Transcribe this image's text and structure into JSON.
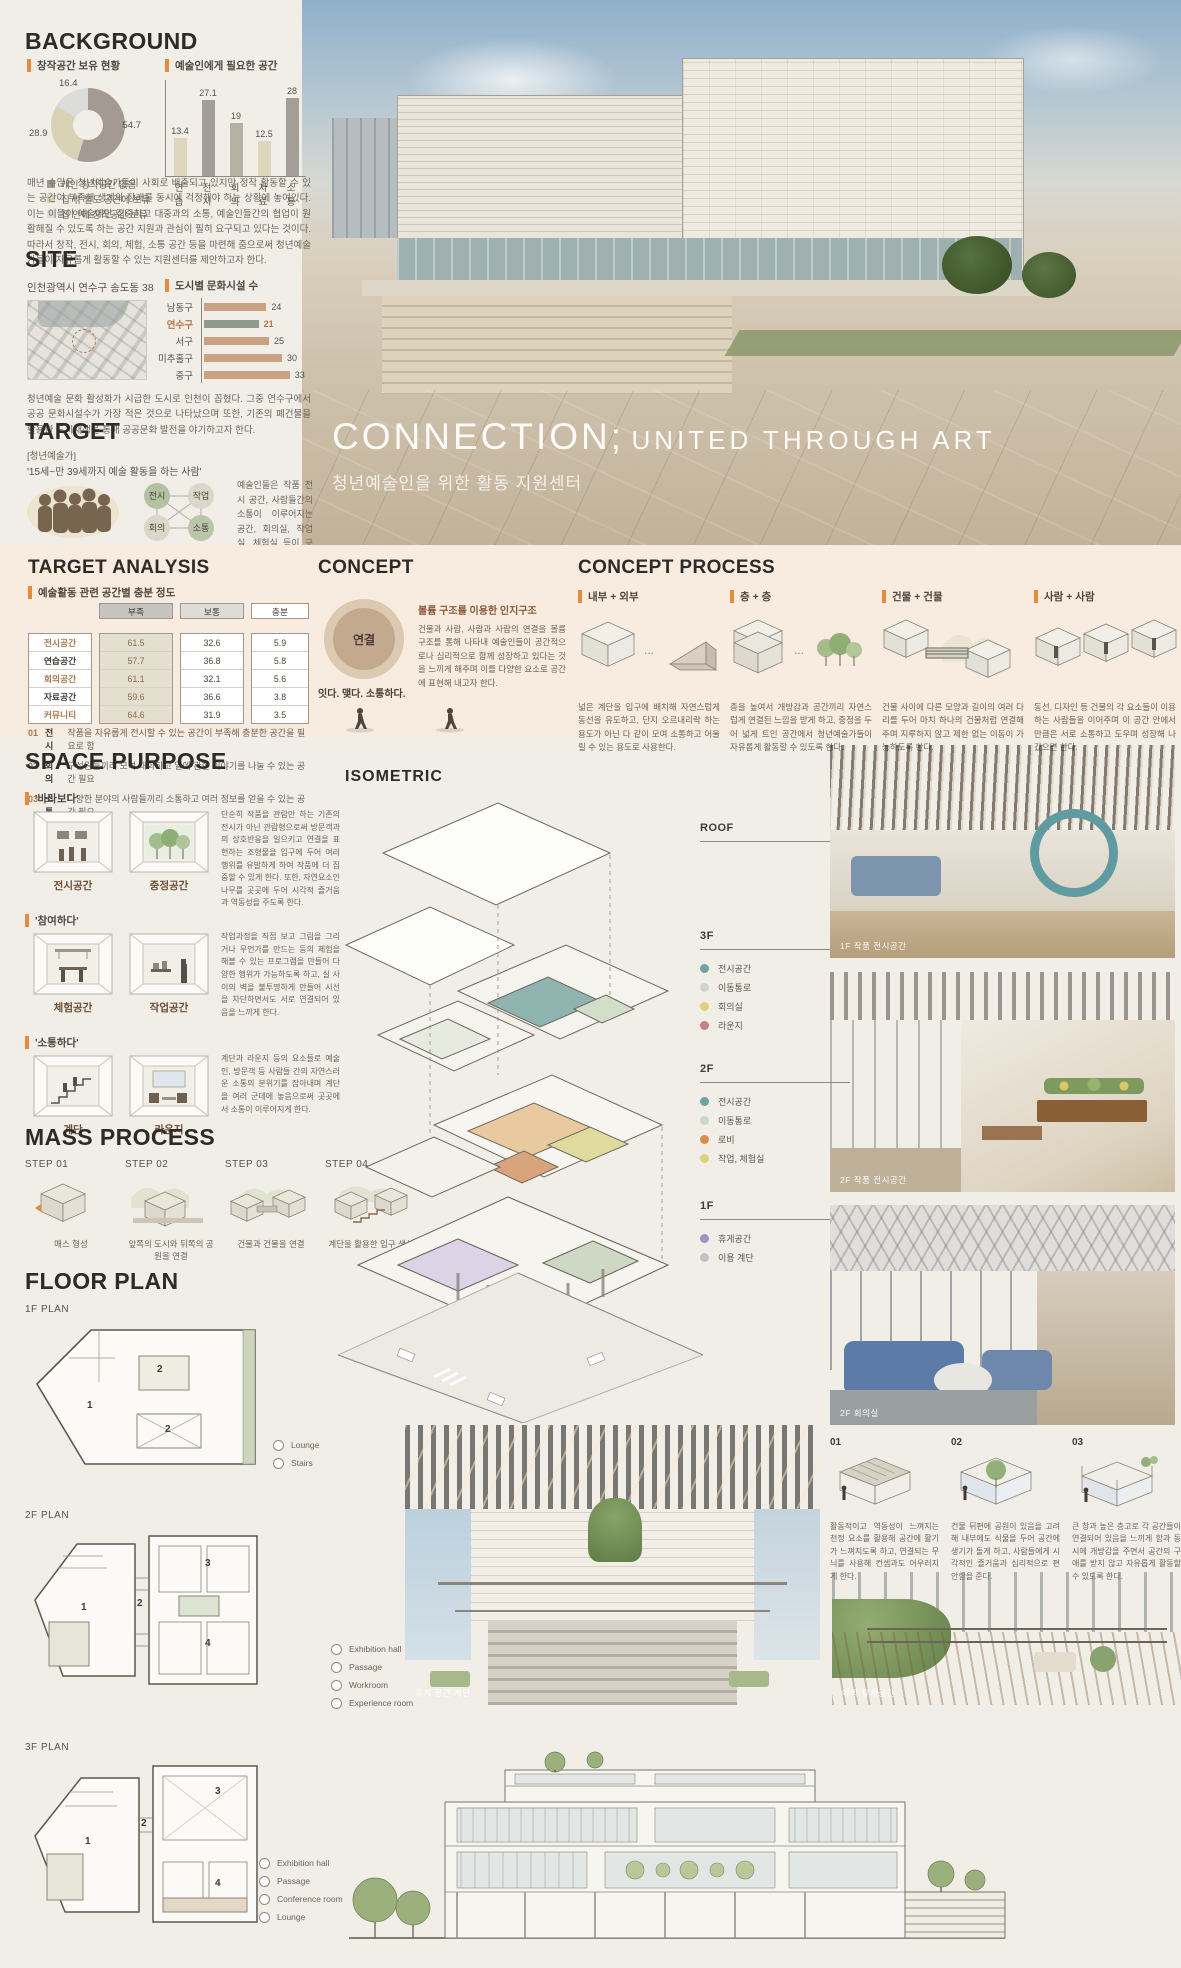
{
  "colors": {
    "accent": "#e58b3f",
    "band": "#f8ebdf",
    "donut": [
      "#a39a93",
      "#d9d2b4",
      "#dcdcda"
    ],
    "bar_beige": "#ddd6bd",
    "bar_gray": "#a49e98",
    "bar_gray2": "#b7b0a5",
    "site_bar": "#c9a183",
    "site_hl": "#8d9a8c",
    "hl_text": "#b0784a"
  },
  "background": {
    "title": "BACKGROUND",
    "donut": {
      "label": "창작공간 보유 현황",
      "values": [
        54.7,
        28.9,
        16.4
      ],
      "value_labels": [
        "54.7",
        "28.9",
        "16.4"
      ],
      "legend": [
        "개인 창작공간 없음",
        "집 밖 별도 공간에 보유",
        "집 안에 창작공간 보유"
      ]
    },
    "needed": {
      "label": "예술인에게 필요한 공간",
      "categories": [
        "연습",
        "전시",
        "회의",
        "자료",
        "소통"
      ],
      "values": [
        13.4,
        27.1,
        19,
        12.5,
        28
      ]
    },
    "paragraph": "매년 수많은 청년예술가들이 사회로 배출되고 있지만 정작 활동할 수 있는 공간이 부족해 생계와 장래를 동시에 걱정해야 하는 상황에 놓여있다. 이는 이들이 예술에만 집중하고 대중과의 소통, 예술인들간의 협업이 원활해질 수 있도록 하는 공간 지원과 관심이 필히 요구되고 있다는 것이다. 따라서 창작, 전시, 회의, 체험, 소통 공간 등을 마련해 줌으로써 청년예술가들이 자유롭게 활동할 수 있는 지원센터를 제안하고자 한다."
  },
  "site": {
    "title": "SITE",
    "address": "인천광역시 연수구 송도동 38",
    "chart": {
      "label": "도시별 문화시설 수",
      "categories": [
        "남동구",
        "연수구",
        "서구",
        "미추홀구",
        "중구"
      ],
      "values": [
        24,
        21,
        25,
        30,
        33
      ],
      "highlight": "연수구"
    },
    "paragraph": "청년예술 문화 활성화가 시급한 도시로 인천이 꼽혔다. 그중 연수구에서 공공 문화시설수가 가장 적은 것으로 나타났으며 또한, 기존의 폐건물을 활용한 도시재생을 통해 공공문화 발전을 야기하고자 한다."
  },
  "target": {
    "title": "TARGET",
    "bracket": "[청년예술가]",
    "quote": "'15세~만 39세까지 예술 활동을 하는 사람'",
    "network": [
      "전시",
      "작업",
      "회의",
      "소통"
    ],
    "paragraph": "예술인들은 작품 전시 공간, 사람들간의 소통이 이루어지는 공간, 회의실, 작업실, 체험실 등이 구비된 자유로운 분위기 속에서 활동하기를 희망한다."
  },
  "hero": {
    "title_main": "CONNECTION;",
    "title_sub": "UNITED THROUGH ART",
    "subtitle": "청년예술인을 위한 활동 지원센터"
  },
  "target_analysis": {
    "title": "TARGET ANALYSIS",
    "label": "예술활동 관련 공간별 충분 정도",
    "headers": [
      "부족",
      "보통",
      "충분"
    ],
    "rows": [
      {
        "name": "전시공간",
        "values": [
          "61.5",
          "32.6",
          "5.9"
        ]
      },
      {
        "name": "연습공간",
        "values": [
          "57.7",
          "36.8",
          "5.8"
        ]
      },
      {
        "name": "회의공간",
        "values": [
          "61.1",
          "32.1",
          "5.6"
        ]
      },
      {
        "name": "자료공간",
        "values": [
          "59.6",
          "36.6",
          "3.8"
        ]
      },
      {
        "name": "커뮤니티",
        "values": [
          "64.6",
          "31.9",
          "3.5"
        ]
      }
    ],
    "notes": [
      {
        "no": "01",
        "label": "전시",
        "text": "작품을 자유롭게 전시할 수 있는 공간이 부족해 충분한 공간을 필요로 함"
      },
      {
        "no": "02",
        "label": "회의",
        "text": "구성원들끼리 모여 대화하고 일에 관한 이야기를 나눌 수 있는 공간 필요"
      },
      {
        "no": "03",
        "label": "소통",
        "text": "다양한 분야의 사람들끼리 소통하고 여러 정보를 얻을 수 있는 공간 필요"
      }
    ]
  },
  "concept": {
    "title": "CONCEPT",
    "circle": "연결",
    "tagline": "잇다. 맺다. 소통하다.",
    "heading": "볼륨 구조를 이용한 인지구조",
    "paragraph": "건물과 사람, 사람과 사람의 연결을 볼륨 구조를 통해 나타내 예술인들이 공간적으로나 심리적으로 함께 성장하고 있다는 것을 느끼게 해주며 이를 다양한 요소로 공간에 표현해 내고자 한다."
  },
  "concept_process": {
    "title": "CONCEPT PROCESS",
    "items": [
      {
        "label": "내부 + 외부",
        "text": "넓은 계단을 입구에 배치해 자연스럽게 동선을 유도하고, 단지 오르내리락 하는 용도가 아닌 다 같이 모여 소통하고 어울릴 수 있는 용도로 사용한다."
      },
      {
        "label": "층 + 층",
        "text": "층을 높여서 개방감과 공간끼리 자연스럽게 연결된 느낌을 받게 하고, 중정을 두어 넓게 트인 공간에서 청년예술가들이 자유롭게 활동할 수 있도록 한다."
      },
      {
        "label": "건물 + 건물",
        "text": "건물 사이에 다른 모양과 길이의 여러 다리를 두어 마치 하나의 건물처럼 연결해주며 지루하지 않고 제한 없는 이동이 가능하도록 한다."
      },
      {
        "label": "사람 + 사람",
        "text": "동선, 디자인 등 건물의 각 요소들이 이용하는 사람들을 이어주며 이 공간 안에서만큼은 서로 소통하고 도우며 성장해 나갔으면 한다."
      }
    ]
  },
  "space_purpose": {
    "title": "SPACE PURPOSE",
    "groups": [
      {
        "quote": "'바라보다'",
        "rooms": [
          "전시공간",
          "중정공간"
        ],
        "text": "단순히 작품을 관람만 하는 기존의 전시가 아닌 관람형으로써 방문객과의 상호반응을 일으키고 연결을 표현하는 조형물을 입구에 두어 여러 행위를 유발하게 하여 작품에 더 집중할 수 있게 한다. 또한, 자연요소인 나무를 곳곳에 두어 시각적 즐거움과 역동성을 주도록 한다."
      },
      {
        "quote": "'참여하다'",
        "rooms": [
          "체험공간",
          "작업공간"
        ],
        "text": "작업과정을 직접 보고 그림을 그리거나 무언가를 만드는 등의 체험을 해볼 수 있는 프로그램을 만들어 다양한 행위가 가능하도록 하고, 실 사이의 벽을 불투명하게 만들어 시선을 차단하면서도 서로 연결되어 있음을 느끼게 한다."
      },
      {
        "quote": "'소통하다'",
        "rooms": [
          "계단",
          "라운지"
        ],
        "text": "계단과 라운지 등의 요소들로 예술인, 방문객 등 사람들 간의 자연스러운 소통의 분위기를 잡아내며 계단을 여러 군데에 놓음으로써 곳곳에서 소통이 이루어지게 한다."
      }
    ]
  },
  "mass_process": {
    "title": "MASS PROCESS",
    "steps": [
      {
        "label": "STEP 01",
        "caption": "매스 형성"
      },
      {
        "label": "STEP 02",
        "caption": "앞쪽의 도시와 뒤쪽의 공원을 연결"
      },
      {
        "label": "STEP 03",
        "caption": "건물과 건물을 연결"
      },
      {
        "label": "STEP 04",
        "caption": "계단을 활용한 입구 생성"
      }
    ]
  },
  "floor_plan": {
    "title": "FLOOR PLAN",
    "plans": [
      {
        "label": "1F PLAN",
        "numbers": [
          "1",
          "2",
          "2"
        ],
        "legend": [
          "Lounge",
          "Stairs"
        ]
      },
      {
        "label": "2F PLAN",
        "numbers": [
          "1",
          "2",
          "3",
          "4"
        ],
        "legend": [
          "Exhibition hall",
          "Passage",
          "Workroom",
          "Experience room"
        ]
      },
      {
        "label": "3F PLAN",
        "numbers": [
          "1",
          "2",
          "3",
          "4"
        ],
        "legend": [
          "Exhibition hall",
          "Passage",
          "Conference room",
          "Lounge"
        ]
      }
    ]
  },
  "isometric": {
    "title": "ISOMETRIC",
    "levels": [
      {
        "name": "ROOF",
        "items": []
      },
      {
        "name": "3F",
        "items": [
          {
            "label": "전시공간",
            "color": "#6fa3a0"
          },
          {
            "label": "이동통로",
            "color": "#ccd6cc"
          },
          {
            "label": "회의실",
            "color": "#ddd37b"
          },
          {
            "label": "라운지",
            "color": "#ca7d89"
          }
        ]
      },
      {
        "name": "2F",
        "items": [
          {
            "label": "전시공간",
            "color": "#6fa3a0"
          },
          {
            "label": "이동통로",
            "color": "#ccd6cc"
          },
          {
            "label": "로비",
            "color": "#dd8a4a"
          },
          {
            "label": "작업, 체험실",
            "color": "#ddd37b"
          }
        ]
      },
      {
        "name": "1F",
        "items": [
          {
            "label": "휴게공간",
            "color": "#a28fc5"
          },
          {
            "label": "이용 계단",
            "color": "#c3c3c3"
          }
        ]
      }
    ]
  },
  "photos": {
    "p1": "1F 작품 전시공간",
    "p2": "2F 작품 전시공간",
    "p3": "2F 회의실",
    "p4": "휴게 공간 계단",
    "p5": "야외 휴게공간"
  },
  "details": {
    "items": [
      {
        "no": "01",
        "text": "활동적이고 역동성이 느껴지는 천정 요소를 활용해 공간에 활기가 느껴지도록 하고, 연결되는 무늬를 사용해 컨셉과도 어우러지게 한다."
      },
      {
        "no": "02",
        "text": "건물 뒤편에 공원이 있음을 고려해 내부에도 식물을 두어 공간에 생기가 돌게 하고, 사람들에게 시각적인 즐거움과 심리적으로 편안함을 준다."
      },
      {
        "no": "03",
        "text": "큰 창과 높은 층고로 각 공간들이 연결되어 있음을 느끼게 함과 동시에 개방감을 주면서 공간의 구애를 받지 않고 자유롭게 활동할 수 있도록 한다."
      }
    ]
  }
}
